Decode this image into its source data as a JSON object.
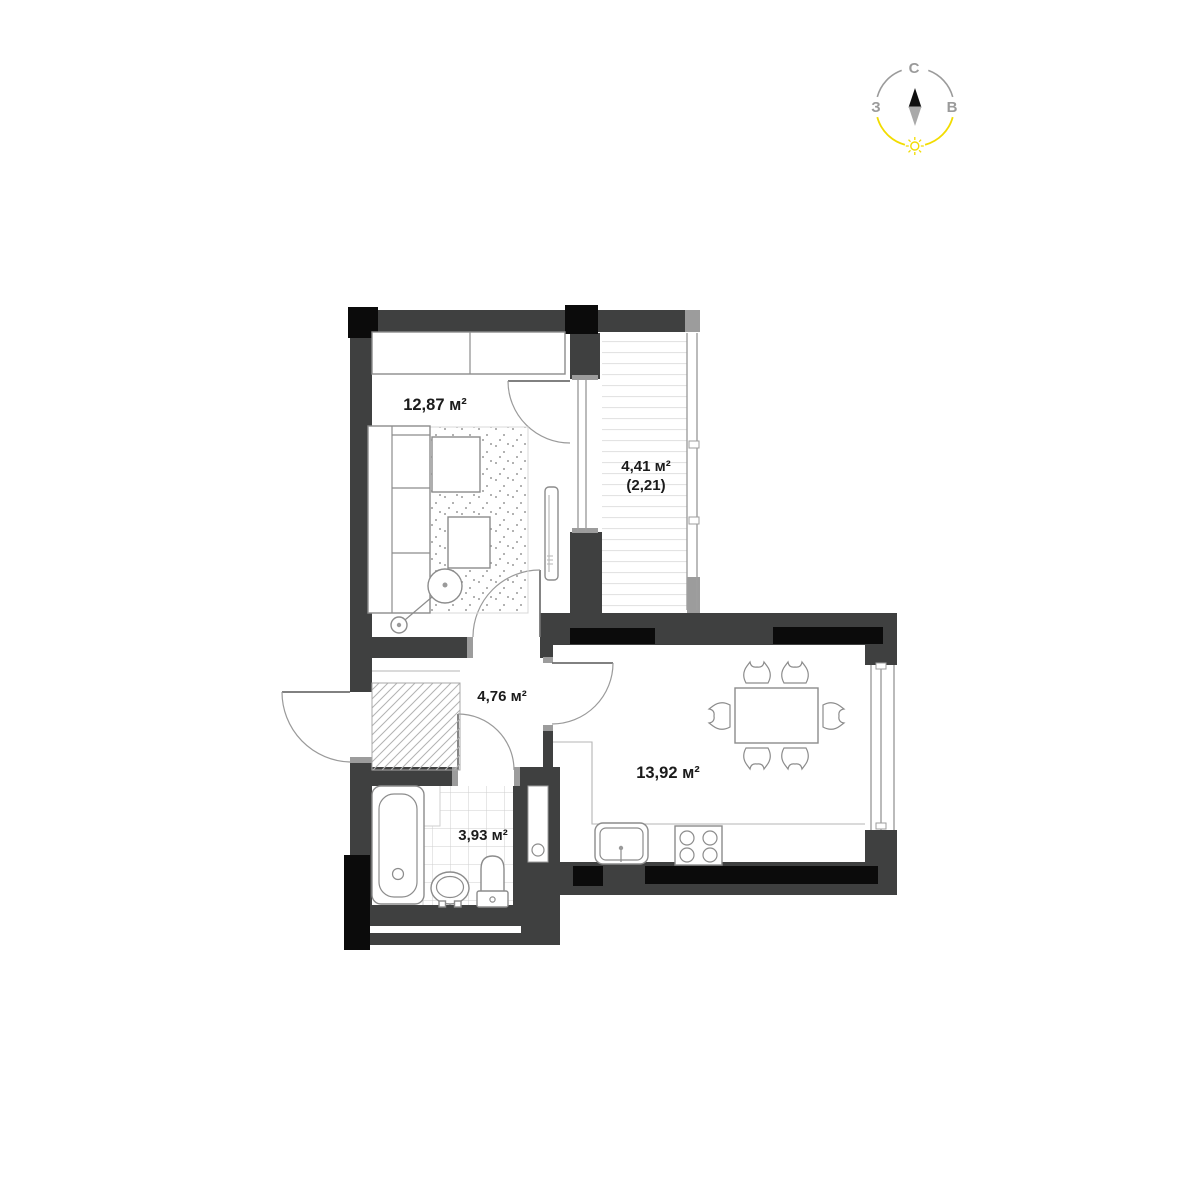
{
  "page": {
    "background": "#ffffff"
  },
  "colors": {
    "wall": "#3f4040",
    "black": "#0b0b0b",
    "light_wall": "#9c9c9c",
    "furniture_line": "#8c8c8c",
    "thin_line": "#b5b5b5",
    "door_arc": "#9a9a9a",
    "door_leaf": "#6f6f6f",
    "glass": "#9e9e9e",
    "tile_line": "#cfcfcf",
    "stripe_line": "#e3e3e3",
    "hatch_line": "#b2b2b2",
    "dot": "#9a9a9a",
    "text": "#1b1b1b",
    "compass_gray": "#9b9b9b",
    "compass_yellow": "#f2dc00"
  },
  "compass": {
    "north_label": "С",
    "west_label": "З",
    "east_label": "В"
  },
  "rooms": {
    "living_room": {
      "area": "12,87 м²"
    },
    "balcony": {
      "area": "4,41 м²",
      "area_note": "(2,21)"
    },
    "hallway": {
      "area": "4,76 м²"
    },
    "kitchen": {
      "area": "13,92 м²"
    },
    "bathroom": {
      "area": "3,93 м²"
    }
  }
}
